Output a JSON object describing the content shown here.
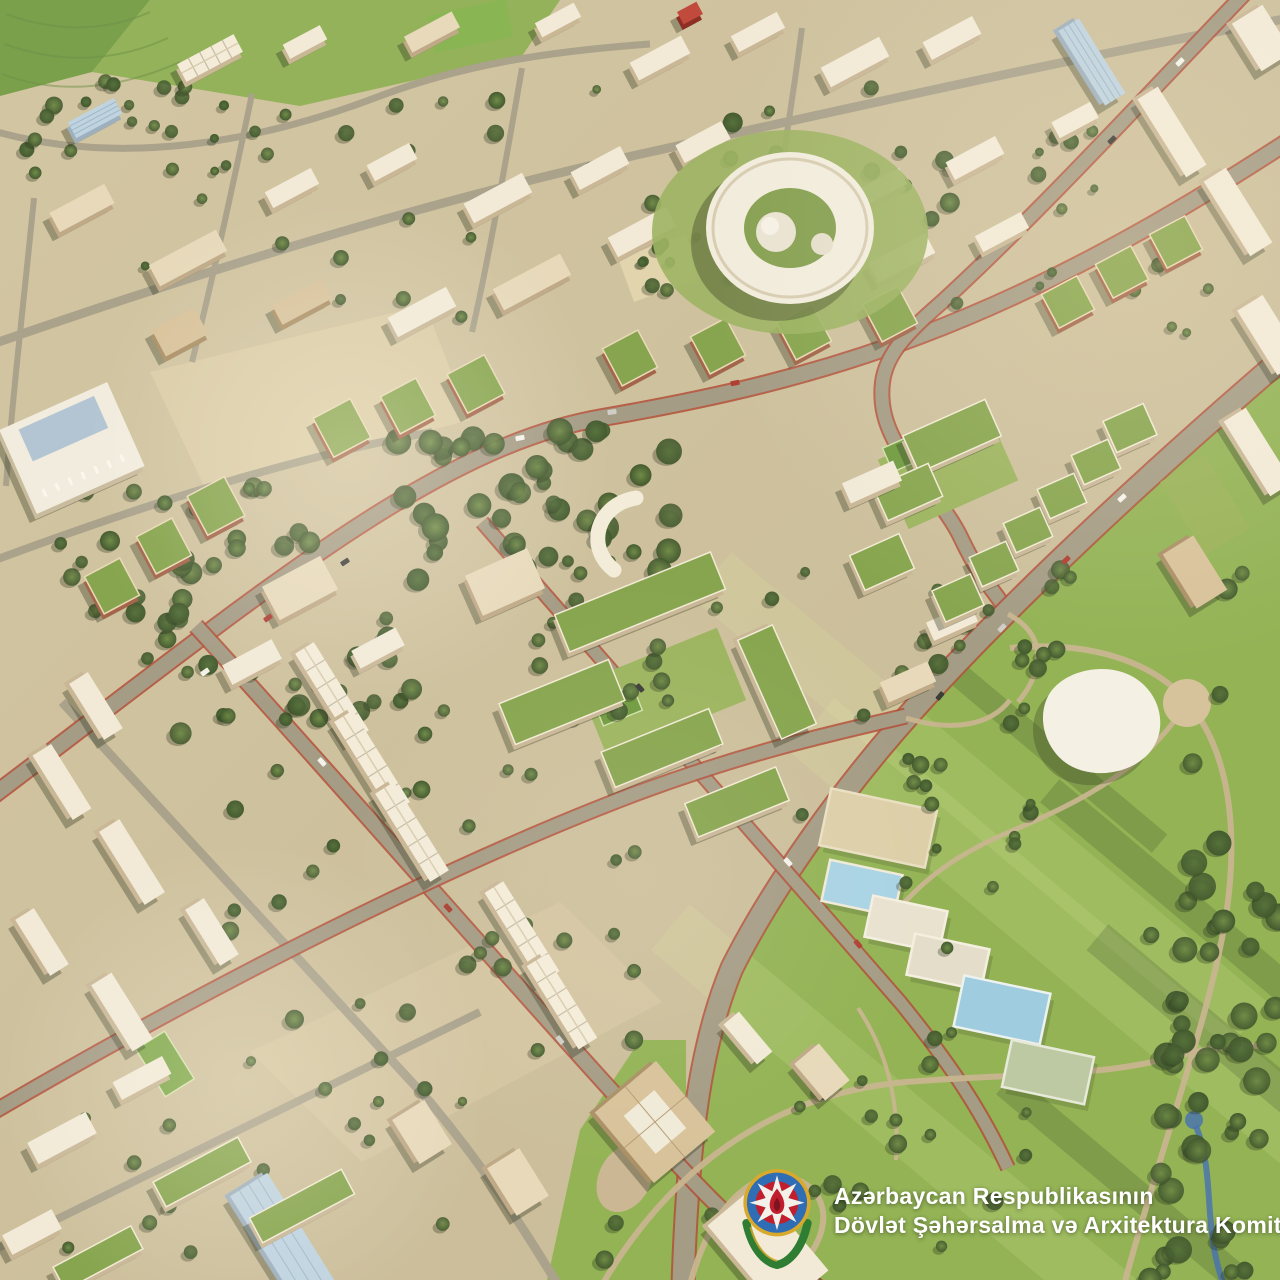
{
  "watermark": {
    "line1": "Azərbaycan Respublikasının",
    "line2": "Dövlət Şəhərsalma və Arxitektura Komitəsi",
    "text_color": "#ffffff",
    "emblem": {
      "name": "azerbaijan-state-emblem",
      "gold": "#d9a92c",
      "blue": "#2f6db4",
      "red": "#c21f2e",
      "green": "#3c8f44",
      "white": "#f4f1ea",
      "flame": "#bf1e2d",
      "flame_core": "#7e1420",
      "wreath": "#2e7d32"
    }
  },
  "scene": {
    "palette": {
      "ground1": "#d3c6a2",
      "ground2": "#c8ba96",
      "park": "#93b355",
      "park_light": "#a6c162",
      "tree1": "#6f8c46",
      "tree2": "#42582e",
      "tree3": "#55713a",
      "road_major": "#a59c85",
      "road_minor": "#aaa28b",
      "bike_edge": "#b14f3a",
      "path": "#c8b58f",
      "plaza": "#dbcca6",
      "roof_white": "#f2ead7",
      "wall_white": "#c9b796",
      "roof_cream": "#e7d9ba",
      "wall_cream": "#bfa987",
      "roof_tan": "#d8c29a",
      "wall_tan": "#ab9066",
      "roof_green": "#87a54e",
      "wall_brick": "#a4654a",
      "roof_glass": "#bfd3e0",
      "wall_glass": "#9fb0bd",
      "roof_red": "#c04b3c",
      "wall_red": "#8e2f26",
      "pool": "#a9d3e3",
      "stream": "#4a74ad",
      "shadow": "rgba(47,52,30,0.35)",
      "ring_lawn": "#9db463"
    },
    "fields": [
      {
        "pts": "0,0 150,0 92,72 0,96",
        "fill": "#7aa04c"
      },
      {
        "pts": "150,0 560,0 522,56 300,106 92,72",
        "fill": "#93b25a"
      }
    ],
    "field_contours": [
      "M6,14 C60,34 110,30 150,12",
      "M4,44 C66,66 120,60 168,38",
      "M2,74 C60,96 122,88 180,62"
    ],
    "park_poly": "1290,352 1150,472 1005,612 908,716 842,790 772,888 732,968 702,1068 687,1180 682,1290 1290,1290",
    "park_west_poly": "545,1290 580,1130 640,1040 686,1040 686,1290",
    "park_bands": [
      [
        980,
        800,
        700,
        60,
        40
      ],
      [
        1080,
        950,
        700,
        70,
        40
      ],
      [
        900,
        1120,
        600,
        60,
        40
      ]
    ],
    "park_shadows": [
      [
        1180,
        900,
        340,
        30,
        40
      ],
      [
        1220,
        1040,
        320,
        34,
        40
      ],
      [
        1120,
        1180,
        300,
        28,
        40
      ],
      [
        1060,
        760,
        260,
        24,
        40
      ]
    ],
    "plazas": [
      {
        "pts": "150,372 425,305 470,420 205,488",
        "fill": "#dbcca6",
        "op": 0.95
      },
      {
        "pts": "250,1052 560,902 662,1002 362,1162",
        "fill": "#d6c7a2",
        "op": 0.8
      }
    ],
    "plaza_rects": [
      [
        660,
        268,
        72,
        46,
        -20
      ]
    ],
    "teardrop": [
      625,
      1178,
      26,
      36,
      28
    ],
    "circle_plaza": [
      1187,
      703,
      24
    ],
    "roads_minor": [
      {
        "d": "M-10,130 C120,168 260,142 380,96 C460,66 540,52 650,44",
        "w": 7
      },
      {
        "d": "M-10,345 C200,272 430,200 650,152 C860,106 1060,60 1290,18",
        "w": 9
      },
      {
        "d": "M-10,562 C150,502 300,456 432,432",
        "w": 8
      },
      {
        "d": "M252,94 C232,190 212,282 192,362",
        "w": 6
      },
      {
        "d": "M522,68 C506,160 490,252 472,332",
        "w": 6
      },
      {
        "d": "M802,28 C790,120 776,202 762,282",
        "w": 6
      },
      {
        "d": "M34,198 C24,300 12,400 6,486",
        "w": 6
      },
      {
        "d": "M62,702 C200,852 330,992 430,1102 C480,1162 520,1222 558,1285",
        "w": 9
      },
      {
        "d": "M-10,1252 C180,1160 340,1082 480,1012",
        "w": 8
      }
    ],
    "roads_major": [
      {
        "d": "M-10,798 C250,602 430,448 600,418 C820,380 1000,330 1290,140",
        "w": 15
      },
      {
        "d": "M1248,-10 C1150,92 1040,212 942,302 C898,340 880,362 882,398 C884,452 940,492 962,540 C982,582 996,592 1006,610",
        "w": 13
      },
      {
        "d": "M1290,352 C1150,472 1000,612 908,716 C842,790 772,888 732,968 C702,1040 688,1130 683,1285",
        "w": 21
      },
      {
        "d": "M196,626 C330,772 520,992 640,1122 C718,1212 760,1248 822,1290",
        "w": 14
      },
      {
        "d": "M482,522 C620,682 780,862 900,1002 C952,1066 982,1112 1008,1168",
        "w": 12
      },
      {
        "d": "M-10,1114 C250,962 480,852 640,792 C760,748 840,732 906,716",
        "w": 13
      }
    ],
    "park_paths": [
      {
        "d": "M1008,614 C1052,638 1040,676 1018,702",
        "w": 5
      },
      {
        "d": "M1010,648 C1090,640 1152,662 1186,700 C1232,752 1238,836 1226,916 C1210,1016 1166,1130 1124,1285",
        "w": 6
      },
      {
        "d": "M1186,704 C1146,768 1084,800 1014,830 C960,852 920,880 892,918",
        "w": 5
      },
      {
        "d": "M906,718 C952,732 990,726 1010,700",
        "w": 5
      },
      {
        "d": "M602,1285 C680,1152 790,1092 906,1082 C1004,1074 1092,1076 1152,1062 C1200,1050 1232,1044 1260,1046",
        "w": 6
      },
      {
        "d": "M690,1285 C712,1200 762,1160 802,1182 C842,1204 822,1262 772,1285",
        "w": 6
      },
      {
        "d": "M858,1008 C886,1050 900,1100 896,1160",
        "w": 4
      }
    ],
    "stream": {
      "d": "M1196,1126 C1216,1176 1202,1228 1224,1285",
      "w": 6,
      "pond": [
        1194,
        1120,
        9
      ]
    },
    "lawns": [
      [
        662,
        692,
        150,
        78,
        -22,
        "#9cb45e",
        ""
      ],
      [
        948,
        470,
        120,
        76,
        -24,
        "#9cb45e",
        ""
      ],
      [
        1205,
        505,
        86,
        52,
        58,
        "#9ab257",
        ""
      ],
      [
        618,
        706,
        42,
        26,
        -22,
        "#6f9a3f",
        "#cfe0a8"
      ],
      [
        906,
        452,
        40,
        26,
        -24,
        "#6f9a3f",
        "#cfe0a8"
      ],
      [
        470,
        26,
        80,
        38,
        -12,
        "#8ab553",
        ""
      ],
      [
        165,
        1064,
        56,
        34,
        58,
        "#7fa84a",
        "#d8e2b0"
      ]
    ],
    "sports": [
      [
        878,
        828,
        108,
        58,
        12,
        "#ddcfa8",
        "#e9dfc2"
      ],
      [
        862,
        888,
        74,
        42,
        12,
        "#a9d3e3",
        "#f0ead8"
      ],
      [
        906,
        924,
        76,
        42,
        12,
        "#e9e2cf",
        "#f4efdf"
      ],
      [
        948,
        962,
        76,
        42,
        12,
        "#e4ddc9",
        "#f4efdf"
      ],
      [
        1002,
        1010,
        88,
        52,
        12,
        "#9fccdf",
        "#eef2ee"
      ],
      [
        1048,
        1072,
        84,
        48,
        12,
        "#bcc9a2",
        "#e7ead8"
      ]
    ],
    "tree_clusters": [
      [
        390,
        430,
        330,
        150,
        42,
        7,
        14,
        11
      ],
      [
        60,
        470,
        250,
        170,
        30,
        6,
        12,
        22
      ],
      [
        120,
        610,
        320,
        130,
        26,
        6,
        11,
        33
      ],
      [
        650,
        120,
        300,
        200,
        16,
        6,
        10,
        44
      ],
      [
        220,
        680,
        420,
        380,
        30,
        5,
        10,
        55
      ],
      [
        520,
        560,
        330,
        260,
        24,
        5,
        9,
        66
      ],
      [
        920,
        560,
        330,
        230,
        18,
        6,
        11,
        77
      ],
      [
        1150,
        830,
        130,
        450,
        46,
        7,
        14,
        88
      ],
      [
        600,
        1030,
        430,
        230,
        26,
        5,
        10,
        99
      ],
      [
        20,
        80,
        500,
        100,
        22,
        5,
        9,
        12
      ],
      [
        80,
        80,
        900,
        240,
        34,
        4,
        8,
        13
      ],
      [
        860,
        620,
        180,
        340,
        20,
        5,
        9,
        14
      ],
      [
        1000,
        120,
        260,
        220,
        18,
        4,
        8,
        15
      ],
      [
        60,
        1060,
        420,
        200,
        18,
        4,
        8,
        16
      ]
    ],
    "buildings": [
      [
        210,
        58,
        64,
        20,
        -28,
        "rh"
      ],
      [
        305,
        42,
        42,
        16,
        -28,
        "w"
      ],
      [
        432,
        32,
        54,
        18,
        -28,
        "c"
      ],
      [
        558,
        20,
        44,
        16,
        -28,
        "w"
      ],
      [
        660,
        58,
        58,
        20,
        -28,
        "w"
      ],
      [
        758,
        32,
        52,
        18,
        -28,
        "w"
      ],
      [
        690,
        13,
        22,
        14,
        -28,
        "rd"
      ],
      [
        855,
        62,
        66,
        22,
        -28,
        "w"
      ],
      [
        952,
        38,
        56,
        20,
        -28,
        "w"
      ],
      [
        1075,
        120,
        44,
        18,
        -28,
        "w"
      ],
      [
        95,
        118,
        52,
        18,
        -28,
        "gl"
      ],
      [
        82,
        208,
        62,
        22,
        -28,
        "c"
      ],
      [
        188,
        258,
        76,
        24,
        -28,
        "c"
      ],
      [
        292,
        188,
        52,
        18,
        -28,
        "w"
      ],
      [
        392,
        162,
        48,
        18,
        -28,
        "w"
      ],
      [
        498,
        198,
        66,
        22,
        -28,
        "w"
      ],
      [
        600,
        168,
        56,
        20,
        -28,
        "w"
      ],
      [
        703,
        142,
        52,
        20,
        -28,
        "w"
      ],
      [
        642,
        232,
        66,
        22,
        -28,
        "w"
      ],
      [
        532,
        282,
        76,
        24,
        -28,
        "c"
      ],
      [
        422,
        312,
        66,
        22,
        -28,
        "w"
      ],
      [
        302,
        302,
        56,
        22,
        -28,
        "t"
      ],
      [
        180,
        332,
        48,
        30,
        -28,
        "t"
      ],
      [
        782,
        218,
        56,
        20,
        -28,
        "w"
      ],
      [
        880,
        188,
        52,
        18,
        -28,
        "w"
      ],
      [
        975,
        158,
        56,
        20,
        -28,
        "w"
      ],
      [
        902,
        258,
        64,
        22,
        -28,
        "w"
      ],
      [
        1002,
        232,
        52,
        18,
        -28,
        "w"
      ],
      [
        1092,
        62,
        88,
        24,
        58,
        "gl"
      ],
      [
        1172,
        132,
        92,
        24,
        58,
        "w"
      ],
      [
        1238,
        212,
        88,
        26,
        58,
        "w"
      ],
      [
        1262,
        38,
        56,
        36,
        58,
        "w"
      ],
      [
        1270,
        335,
        76,
        30,
        58,
        "w"
      ],
      [
        1258,
        452,
        88,
        26,
        58,
        "w"
      ],
      [
        1068,
        302,
        40,
        38,
        -28,
        "bg"
      ],
      [
        1122,
        272,
        40,
        38,
        -28,
        "bg"
      ],
      [
        1176,
        242,
        40,
        38,
        -28,
        "bg"
      ],
      [
        1195,
        572,
        64,
        36,
        58,
        "t"
      ],
      [
        342,
        428,
        42,
        44,
        -28,
        "bg"
      ],
      [
        408,
        406,
        40,
        42,
        -28,
        "bg"
      ],
      [
        476,
        384,
        42,
        44,
        -28,
        "bg"
      ],
      [
        630,
        358,
        40,
        42,
        -28,
        "bg"
      ],
      [
        718,
        346,
        40,
        42,
        -28,
        "bg"
      ],
      [
        804,
        332,
        40,
        42,
        -28,
        "bg"
      ],
      [
        890,
        314,
        40,
        42,
        -28,
        "bg"
      ],
      [
        112,
        586,
        40,
        42,
        -28,
        "bg"
      ],
      [
        164,
        546,
        40,
        42,
        -28,
        "bg"
      ],
      [
        216,
        506,
        42,
        44,
        -28,
        "bg"
      ],
      [
        72,
        448,
        118,
        92,
        -24,
        "cv"
      ],
      [
        300,
        588,
        66,
        38,
        -28,
        "c"
      ],
      [
        252,
        662,
        56,
        22,
        -28,
        "w"
      ],
      [
        378,
        648,
        50,
        20,
        -28,
        "w"
      ],
      [
        505,
        582,
        68,
        44,
        -24,
        "c"
      ],
      [
        640,
        602,
        168,
        40,
        -22,
        "wg"
      ],
      [
        777,
        682,
        108,
        38,
        66,
        "wg"
      ],
      [
        562,
        702,
        118,
        44,
        -22,
        "wg"
      ],
      [
        662,
        748,
        116,
        38,
        -22,
        "wg"
      ],
      [
        737,
        802,
        98,
        36,
        -22,
        "wg"
      ],
      [
        952,
        436,
        90,
        40,
        -24,
        "wg"
      ],
      [
        908,
        492,
        60,
        36,
        -24,
        "wg"
      ],
      [
        872,
        482,
        56,
        22,
        -24,
        "w"
      ],
      [
        882,
        562,
        54,
        38,
        -24,
        "wg"
      ],
      [
        952,
        622,
        48,
        20,
        -24,
        "w"
      ],
      [
        908,
        682,
        52,
        22,
        -24,
        "c"
      ],
      [
        1130,
        428,
        44,
        34,
        -24,
        "wg"
      ],
      [
        1096,
        462,
        40,
        32,
        -24,
        "wg"
      ],
      [
        1062,
        496,
        40,
        32,
        -24,
        "wg"
      ],
      [
        1028,
        530,
        40,
        32,
        -24,
        "wg"
      ],
      [
        994,
        564,
        40,
        32,
        -24,
        "wg"
      ],
      [
        958,
        598,
        42,
        34,
        -24,
        "wg"
      ],
      [
        96,
        706,
        66,
        22,
        58,
        "w"
      ],
      [
        62,
        782,
        76,
        22,
        58,
        "w"
      ],
      [
        132,
        862,
        86,
        24,
        58,
        "w"
      ],
      [
        42,
        942,
        66,
        22,
        58,
        "w"
      ],
      [
        122,
        1012,
        78,
        24,
        58,
        "w"
      ],
      [
        212,
        932,
        66,
        22,
        58,
        "w"
      ],
      [
        332,
        692,
        104,
        22,
        58,
        "rh"
      ],
      [
        372,
        762,
        108,
        22,
        58,
        "rh"
      ],
      [
        412,
        832,
        104,
        22,
        58,
        "rh"
      ],
      [
        522,
        932,
        106,
        22,
        58,
        "rh"
      ],
      [
        562,
        1002,
        98,
        22,
        58,
        "rh"
      ],
      [
        142,
        1078,
        56,
        20,
        -28,
        "w"
      ],
      [
        282,
        1238,
        126,
        44,
        58,
        "gl"
      ],
      [
        62,
        1138,
        66,
        24,
        -28,
        "w"
      ],
      [
        32,
        1232,
        56,
        22,
        -28,
        "w"
      ],
      [
        202,
        1172,
        96,
        28,
        -28,
        "wg"
      ],
      [
        302,
        1206,
        104,
        28,
        -28,
        "wg"
      ],
      [
        98,
        1258,
        88,
        26,
        -28,
        "wg"
      ],
      [
        422,
        1132,
        52,
        38,
        58,
        "c"
      ],
      [
        518,
        1182,
        56,
        38,
        58,
        "c"
      ],
      [
        655,
        1122,
        92,
        80,
        50,
        "t2"
      ],
      [
        748,
        1038,
        52,
        20,
        50,
        "w"
      ],
      [
        822,
        1072,
        48,
        32,
        50,
        "c"
      ],
      [
        768,
        1248,
        112,
        64,
        50,
        "w"
      ]
    ],
    "ring": {
      "cx": 790,
      "cy": 228,
      "rx": 84,
      "ry": 76,
      "hole_rx": 46,
      "hole_ry": 40,
      "dome": [
        776,
        232,
        20
      ],
      "dome_hi": [
        770,
        226,
        9
      ],
      "dome2": [
        822,
        244,
        11
      ],
      "lawn": [
        790,
        232,
        138,
        102
      ]
    },
    "crescent": {
      "d": "M636,498 C598,504 584,546 614,570",
      "w": 15
    },
    "pavilion": {
      "d": "M1052,690 C1070,668 1110,662 1135,678 C1162,695 1168,730 1150,752 C1128,778 1082,780 1060,758 C1040,738 1038,708 1052,690 Z"
    },
    "cars": [
      [
        205,
        672,
        -36,
        "w"
      ],
      [
        268,
        618,
        -36,
        "r"
      ],
      [
        345,
        562,
        -34,
        "d"
      ],
      [
        520,
        438,
        -12,
        "w"
      ],
      [
        612,
        412,
        -8,
        "s"
      ],
      [
        735,
        383,
        -12,
        "r"
      ],
      [
        1180,
        62,
        -45,
        "w"
      ],
      [
        1112,
        140,
        -45,
        "d"
      ],
      [
        1122,
        498,
        -42,
        "w"
      ],
      [
        1066,
        560,
        -44,
        "r"
      ],
      [
        1002,
        628,
        -46,
        "s"
      ],
      [
        940,
        696,
        -50,
        "d"
      ],
      [
        322,
        762,
        48,
        "w"
      ],
      [
        448,
        908,
        48,
        "r"
      ],
      [
        560,
        1040,
        52,
        "s"
      ],
      [
        640,
        688,
        48,
        "d"
      ],
      [
        788,
        862,
        48,
        "w"
      ],
      [
        858,
        944,
        50,
        "r"
      ]
    ],
    "car_colors": {
      "w": "#f4f1e8",
      "r": "#ae4034",
      "d": "#3c3c38",
      "s": "#cfcdc4"
    },
    "glows": [
      [
        350,
        455,
        265,
        "rgba(255,247,225,0.32)"
      ],
      [
        245,
        1085,
        245,
        "rgba(255,247,225,0.28)"
      ],
      [
        1130,
        250,
        420,
        "rgba(255,238,200,0.22)"
      ],
      [
        640,
        880,
        300,
        "rgba(255,250,235,0.10)"
      ]
    ]
  }
}
